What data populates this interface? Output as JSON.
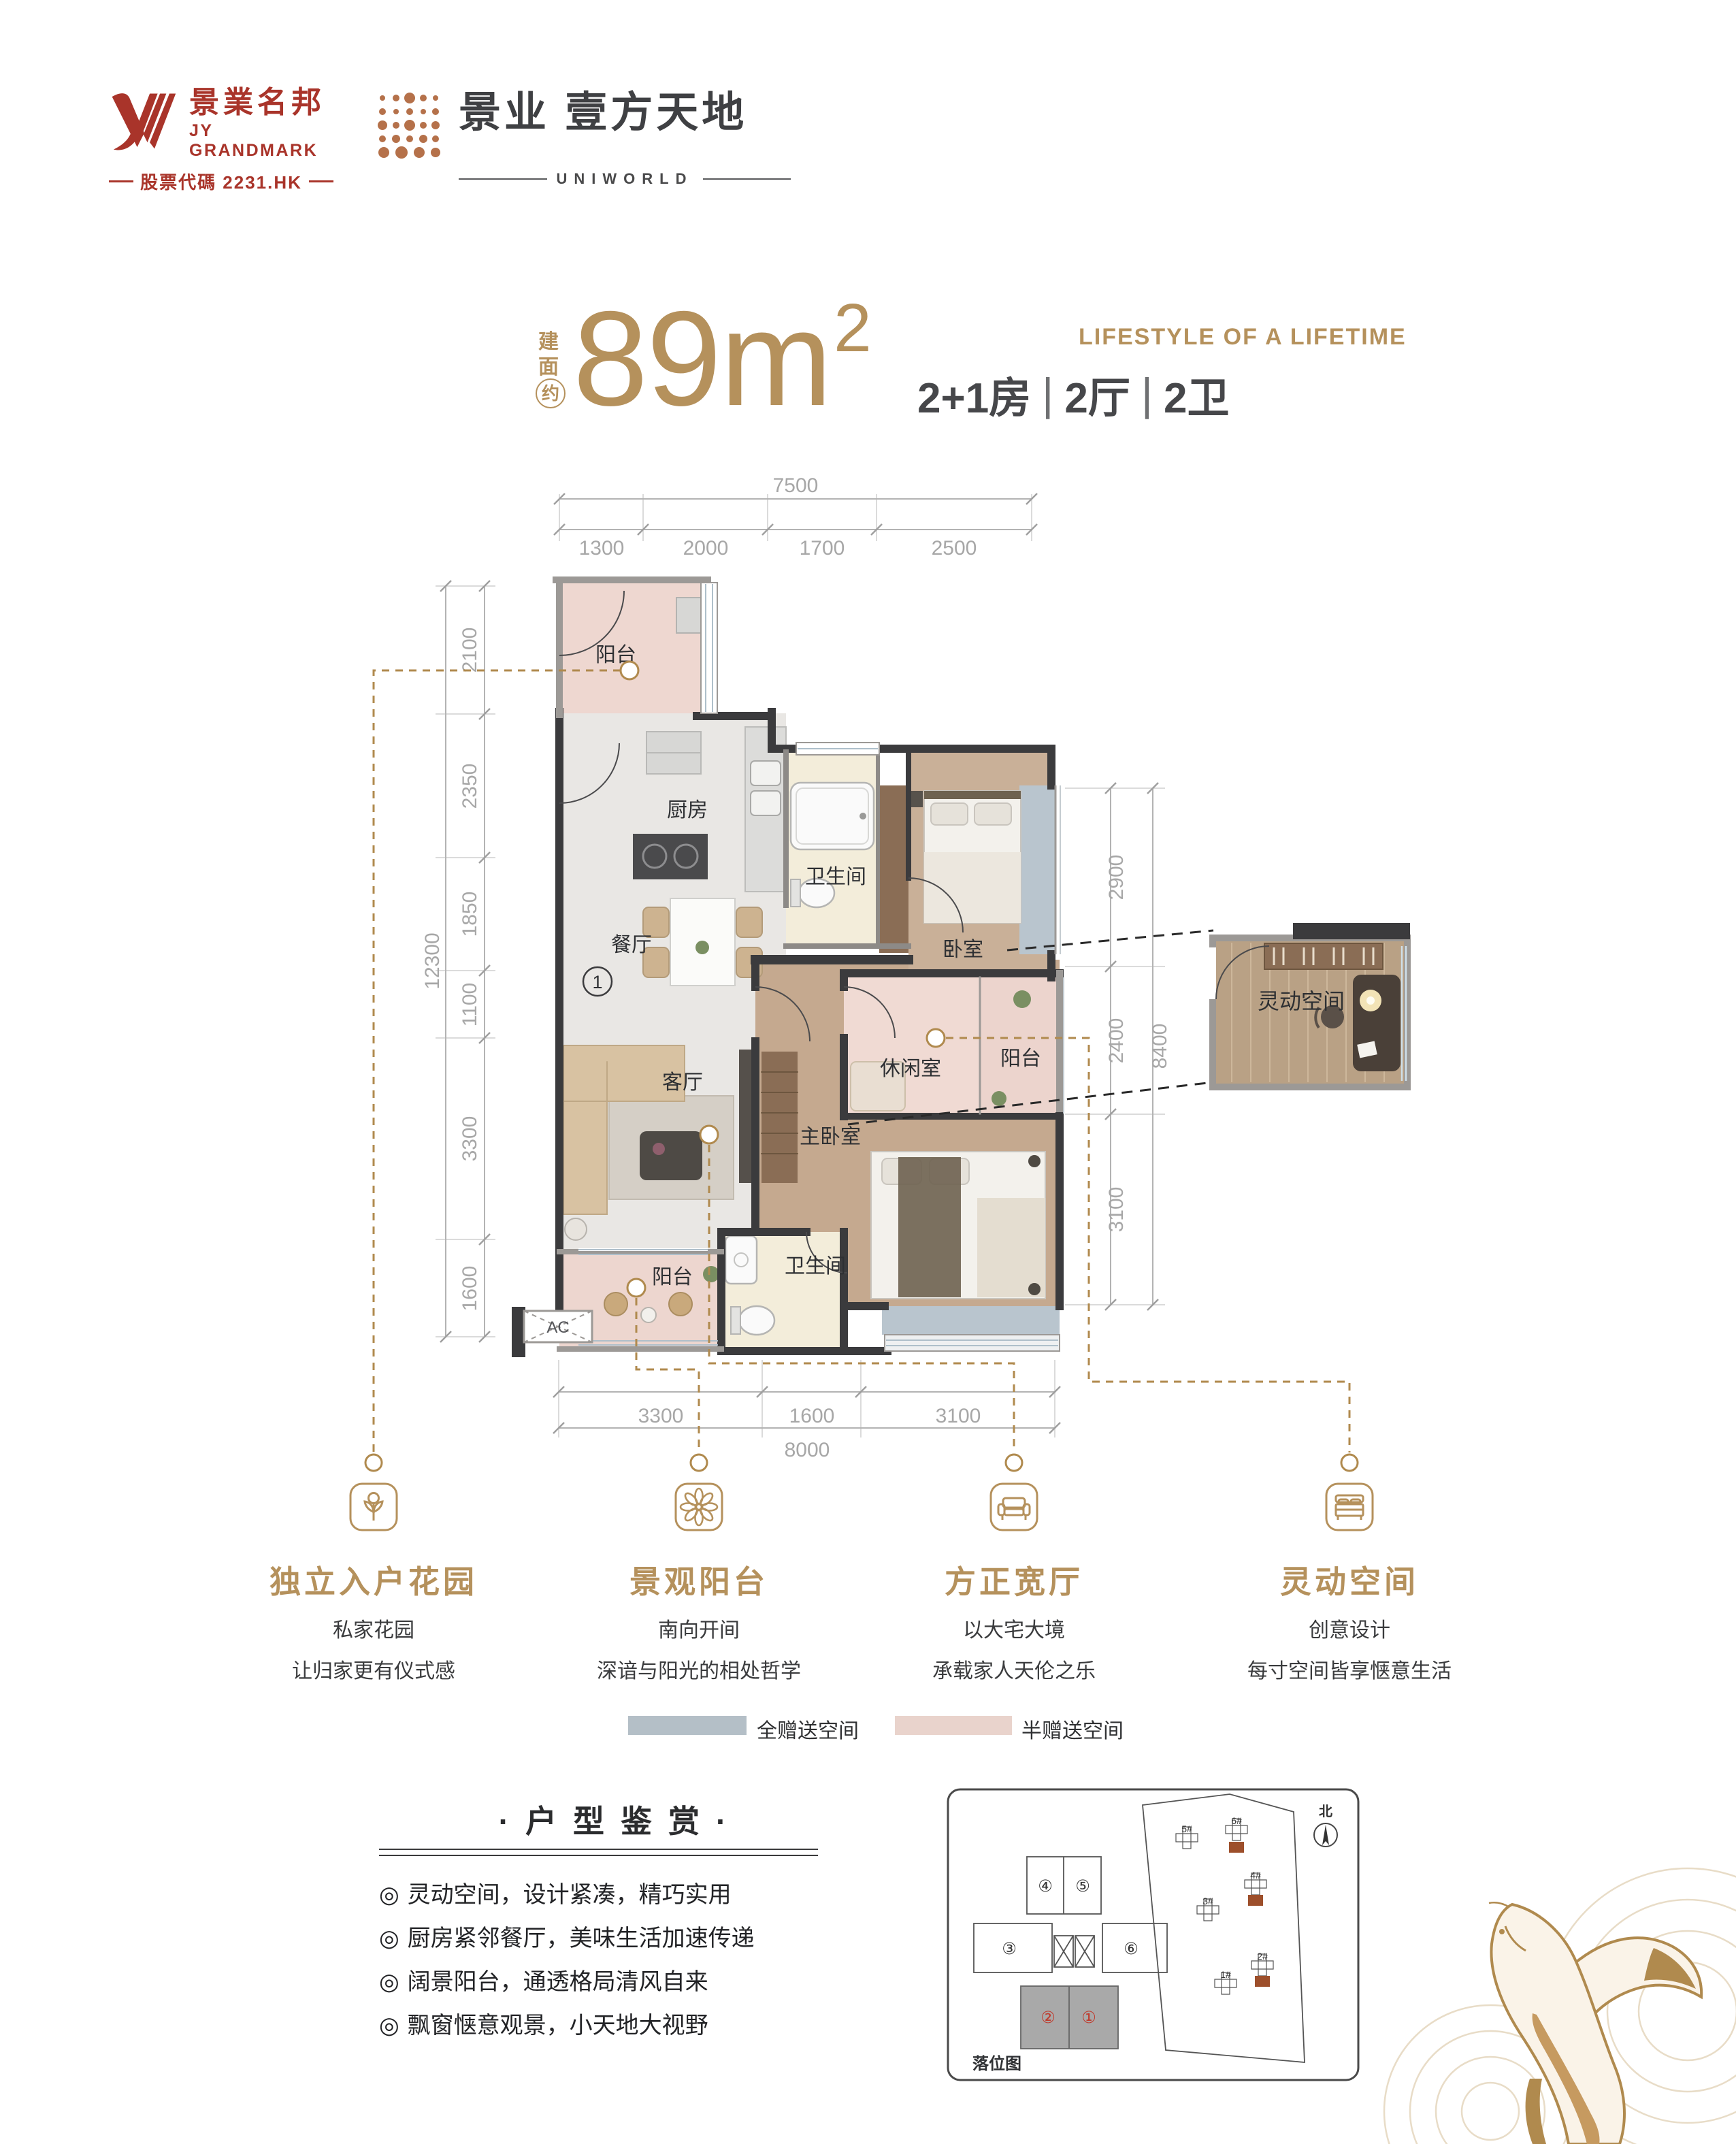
{
  "brand": {
    "logo_cn": "景業名邦",
    "logo_en": "JY GRANDMARK",
    "stock": "股票代碼 2231.HK",
    "project_cn": "景业 壹方天地",
    "project_en": "UNIWORLD"
  },
  "title": {
    "area_label": "建面",
    "approx": "约",
    "area_value": "89m",
    "area_sup": "2",
    "tagline": "LIFESTYLE OF A LIFETIME",
    "spec": [
      "2+1房",
      "2厅",
      "2卫"
    ]
  },
  "floorplan": {
    "rooms": [
      "阳台",
      "厨房",
      "卫生间",
      "卧室",
      "餐厅",
      "客厅",
      "休闲室",
      "阳台",
      "主卧室",
      "卫生间",
      "阳台"
    ],
    "flex_room": "灵动空间",
    "unit_marker": "1",
    "ac_label": "AC",
    "dims": {
      "top_total": "7500",
      "top": [
        "1300",
        "2000",
        "1700",
        "2500"
      ],
      "left_total": "12300",
      "left": [
        "2100",
        "2350",
        "1850",
        "1100",
        "3300",
        "1600"
      ],
      "right_total": "8400",
      "right": [
        "2900",
        "2400",
        "3100"
      ],
      "bottom_total": "8000",
      "bottom": [
        "3300",
        "1600",
        "3100"
      ]
    }
  },
  "features": [
    {
      "icon": "flower-icon",
      "title": "独立入户花园",
      "line1": "私家花园",
      "line2": "让归家更有仪式感"
    },
    {
      "icon": "blossom-icon",
      "title": "景观阳台",
      "line1": "南向开间",
      "line2": "深谙与阳光的相处哲学"
    },
    {
      "icon": "sofa-icon",
      "title": "方正宽厅",
      "line1": "以大宅大境",
      "line2": "承载家人天伦之乐"
    },
    {
      "icon": "bed-icon",
      "title": "灵动空间",
      "line1": "创意设计",
      "line2": "每寸空间皆享惬意生活"
    }
  ],
  "legend": [
    {
      "label": "全赠送空间",
      "color": "#b4bfc7"
    },
    {
      "label": "半赠送空间",
      "color": "#e9d3cc"
    }
  ],
  "review": {
    "title": "·户型鉴赏·",
    "bullet": "◎",
    "items": [
      "灵动空间，设计紧凑，精巧实用",
      "厨房紧邻餐厅，美味生活加速传递",
      "阔景阳台，通透格局清风自来",
      "飘窗惬意观景，小天地大视野"
    ]
  },
  "siteplan": {
    "caption": "落位图",
    "north": "北",
    "plate_units": [
      "④",
      "⑤",
      "③",
      "⑥",
      "②",
      "①"
    ],
    "buildings": [
      "5#",
      "6#",
      "4#",
      "3#",
      "2#",
      "1#"
    ]
  },
  "colors": {
    "gold": "#b5915c",
    "brand_red": "#a9342a",
    "copper": "#b5714a",
    "dark_text": "#3f4043",
    "dim_gray": "#a7a7a7",
    "full_gift": "#b4bfc7",
    "half_gift": "#e9d3cc"
  }
}
